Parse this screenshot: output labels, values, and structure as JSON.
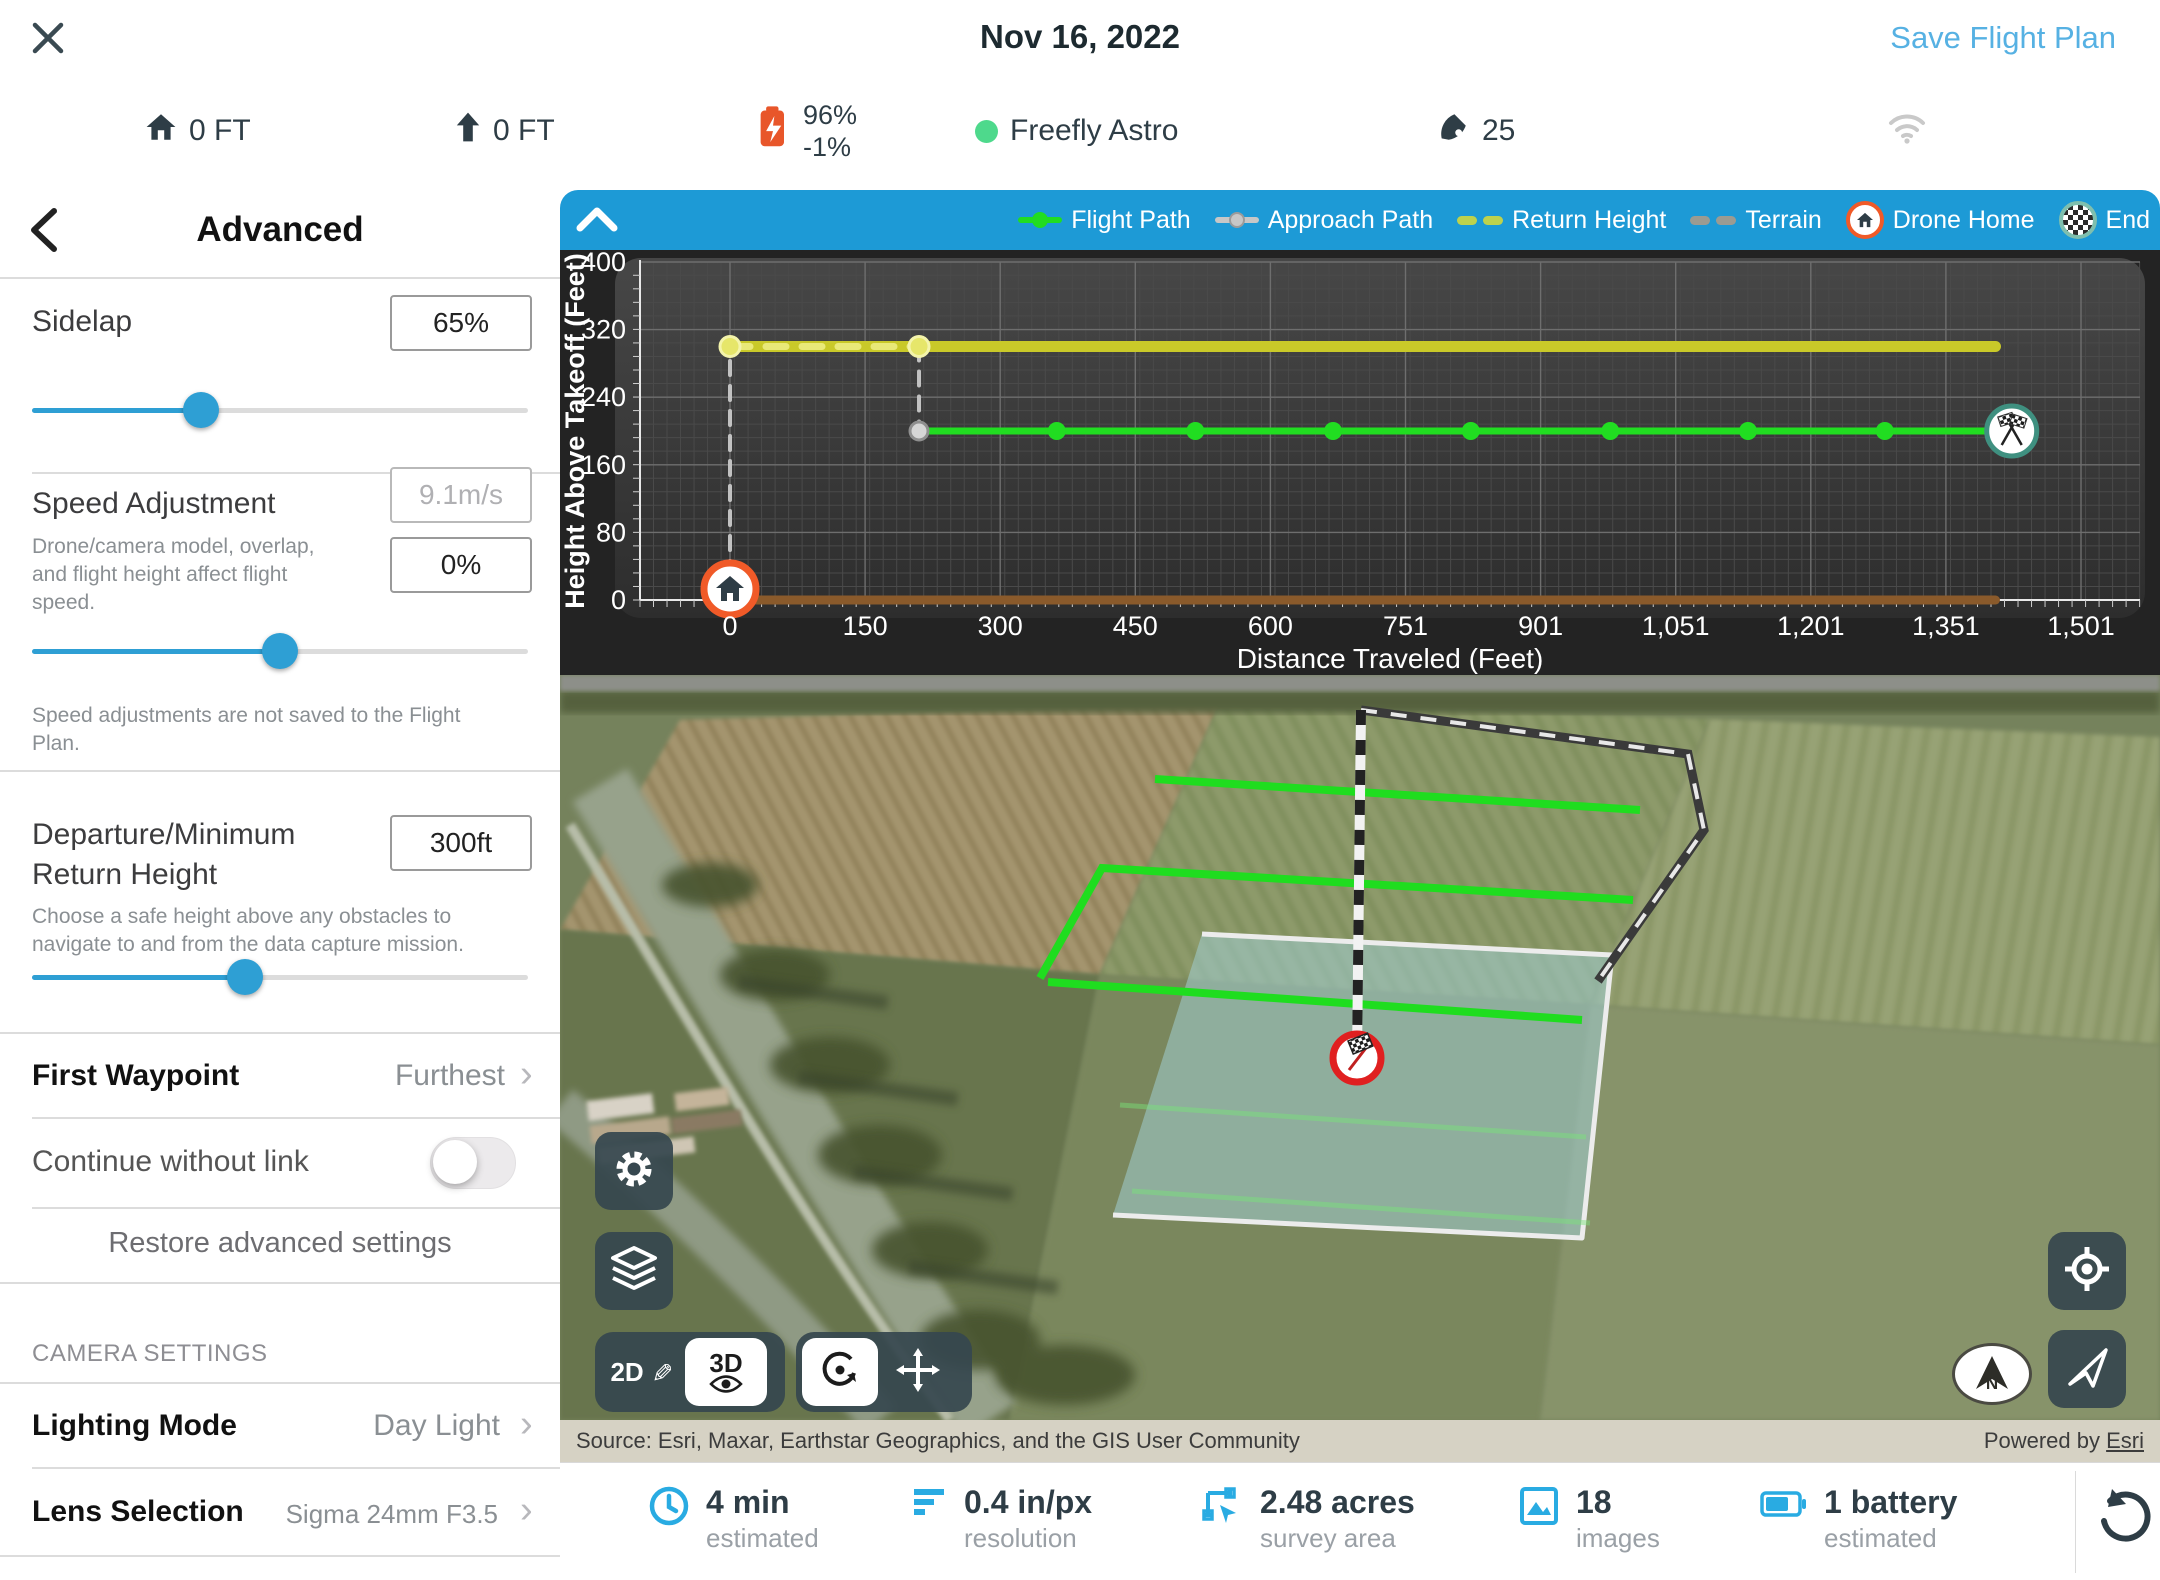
{
  "header": {
    "title": "Nov 16, 2022",
    "save_label": "Save Flight Plan"
  },
  "status": {
    "home_altitude": "0 FT",
    "relative_altitude": "0 FT",
    "battery_percent": "96%",
    "battery_drain": "-1%",
    "drone_name": "Freefly Astro",
    "satellites": "25"
  },
  "sidebar": {
    "title": "Advanced",
    "sidelap": {
      "label": "Sidelap",
      "value": "65%",
      "slider_percent": 34
    },
    "speed": {
      "label": "Speed Adjustment",
      "caption": "Drone/camera model, overlap, and flight height affect flight speed.",
      "speed_value": "9.1m/s",
      "adjust_value": "0%",
      "slider_percent": 50,
      "note": "Speed adjustments are not saved to the Flight Plan."
    },
    "departure": {
      "label": "Departure/Minimum Return Height",
      "value": "300ft",
      "caption": "Choose a safe height above any obstacles to navigate to and from the data capture mission.",
      "slider_percent": 43
    },
    "first_waypoint": {
      "label": "First Waypoint",
      "value": "Furthest"
    },
    "continue_without_link": {
      "label": "Continue without link",
      "enabled": false
    },
    "restore_label": "Restore advanced settings",
    "camera_section": "CAMERA SETTINGS",
    "lighting_mode": {
      "label": "Lighting Mode",
      "value": "Day Light"
    },
    "lens": {
      "label": "Lens Selection",
      "value": "Sigma 24mm F3.5"
    }
  },
  "chart_data": {
    "type": "line",
    "xlabel": "Distance Traveled (Feet)",
    "ylabel": "Height Above Takeoff (Feet)",
    "xlim": [
      0,
      1501
    ],
    "ylim": [
      0,
      400
    ],
    "xticks": [
      "0",
      "150",
      "300",
      "450",
      "600",
      "751",
      "901",
      "1,051",
      "1,201",
      "1,351",
      "1,501"
    ],
    "yticks": [
      "0",
      "80",
      "160",
      "240",
      "320",
      "400"
    ],
    "legend": [
      {
        "label": "Flight Path",
        "swatch": "flight"
      },
      {
        "label": "Approach Path",
        "swatch": "approach"
      },
      {
        "label": "Return Height",
        "swatch": "return"
      },
      {
        "label": "Terrain",
        "swatch": "terrain"
      },
      {
        "label": "Drone Home",
        "swatch": "home"
      },
      {
        "label": "End",
        "swatch": "end"
      }
    ],
    "series": [
      {
        "name": "Return Height",
        "color": "#c9c929",
        "width": 11,
        "dash": "",
        "points": [
          [
            0,
            300
          ],
          [
            1406,
            300
          ]
        ]
      },
      {
        "name": "Return Height departure segment",
        "color": "#e9e978",
        "width": 7,
        "dash": "20 16",
        "points": [
          [
            0,
            300
          ],
          [
            210,
            300
          ]
        ]
      },
      {
        "name": "Approach Path vertical 1",
        "color": "#c2c2c2",
        "width": 4,
        "dash": "14 11",
        "points": [
          [
            0,
            0
          ],
          [
            0,
            300
          ]
        ]
      },
      {
        "name": "Approach Path vertical 2",
        "color": "#c2c2c2",
        "width": 4,
        "dash": "14 11",
        "points": [
          [
            210,
            300
          ],
          [
            210,
            200
          ]
        ]
      },
      {
        "name": "Terrain",
        "color": "#8a5a2b",
        "width": 9,
        "dash": "",
        "points": [
          [
            0,
            0
          ],
          [
            1406,
            0
          ]
        ]
      },
      {
        "name": "Flight Path",
        "color": "#21dd21",
        "width": 7,
        "dash": "",
        "points": [
          [
            210,
            200
          ],
          [
            1424,
            200
          ]
        ]
      }
    ],
    "flight_markers_ft": [
      363,
      517,
      670,
      823,
      978,
      1131,
      1283
    ],
    "return_dots_ft": [
      0,
      210
    ],
    "approach_dot": {
      "x": 210,
      "y": 200
    },
    "waypoints": {
      "home": {
        "x": 0,
        "y": 0
      },
      "end": {
        "x": 1424,
        "y": 200
      }
    }
  },
  "map": {
    "mode_2d": "2D",
    "mode_3d": "3D",
    "compass": "N"
  },
  "attribution": {
    "source": "Source: Esri, Maxar, Earthstar Geographics, and the GIS User Community",
    "powered_prefix": "Powered by ",
    "powered_link": "Esri"
  },
  "stats": {
    "time": {
      "value": "4 min",
      "label": "estimated"
    },
    "resolution": {
      "value": "0.4 in/px",
      "label": "resolution"
    },
    "area": {
      "value": "2.48 acres",
      "label": "survey area"
    },
    "images": {
      "value": "18",
      "label": "images"
    },
    "battery": {
      "value": "1 battery",
      "label": "estimated"
    }
  }
}
